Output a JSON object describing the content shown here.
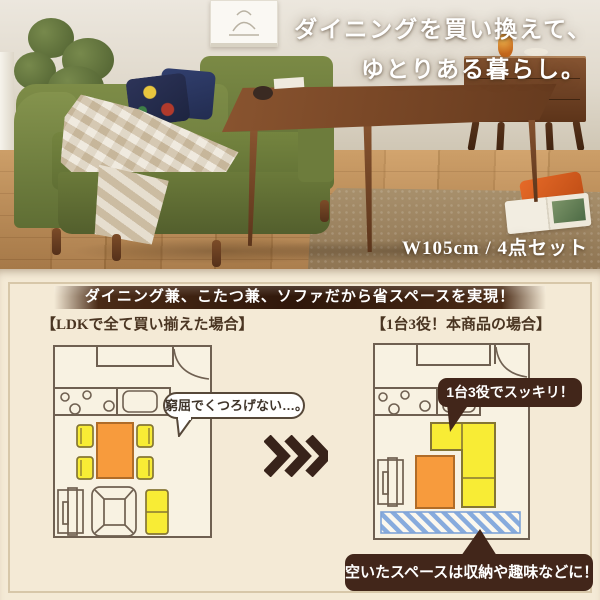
{
  "hero": {
    "headline_line1": "ダイニングを買い換えて、",
    "headline_line2": "ゆとりある暮らし。",
    "size_caption": "W105cm / 4点セット"
  },
  "comparison": {
    "banner": "ダイニング兼、こたつ兼、ソファだから省スペースを実現！",
    "left_plan": {
      "title": "【LDKで全て買い揃えた場合】",
      "bubble": "窮屈でくつろげない…。"
    },
    "right_plan": {
      "title": "【1台3役！本商品の場合】",
      "bubble": "1台3役でスッキリ！",
      "free_space_note": "空いたスペースは収納や趣味などに！"
    },
    "icons": {
      "arrows": "triple-chevron-right",
      "door": "door-swing-arc",
      "free_space": "diagonal-stripe-hatch"
    },
    "colors": {
      "banner_brown": "#32170a",
      "bubble_brown": "#42261a",
      "table_orange": "#f79b3d",
      "furniture_yellow": "#f8ec35",
      "stripe_blue": "#85a9dc",
      "outline_gray": "#6f6051",
      "card_background": "#f4ead6",
      "sofa_green": "#74843f"
    }
  }
}
